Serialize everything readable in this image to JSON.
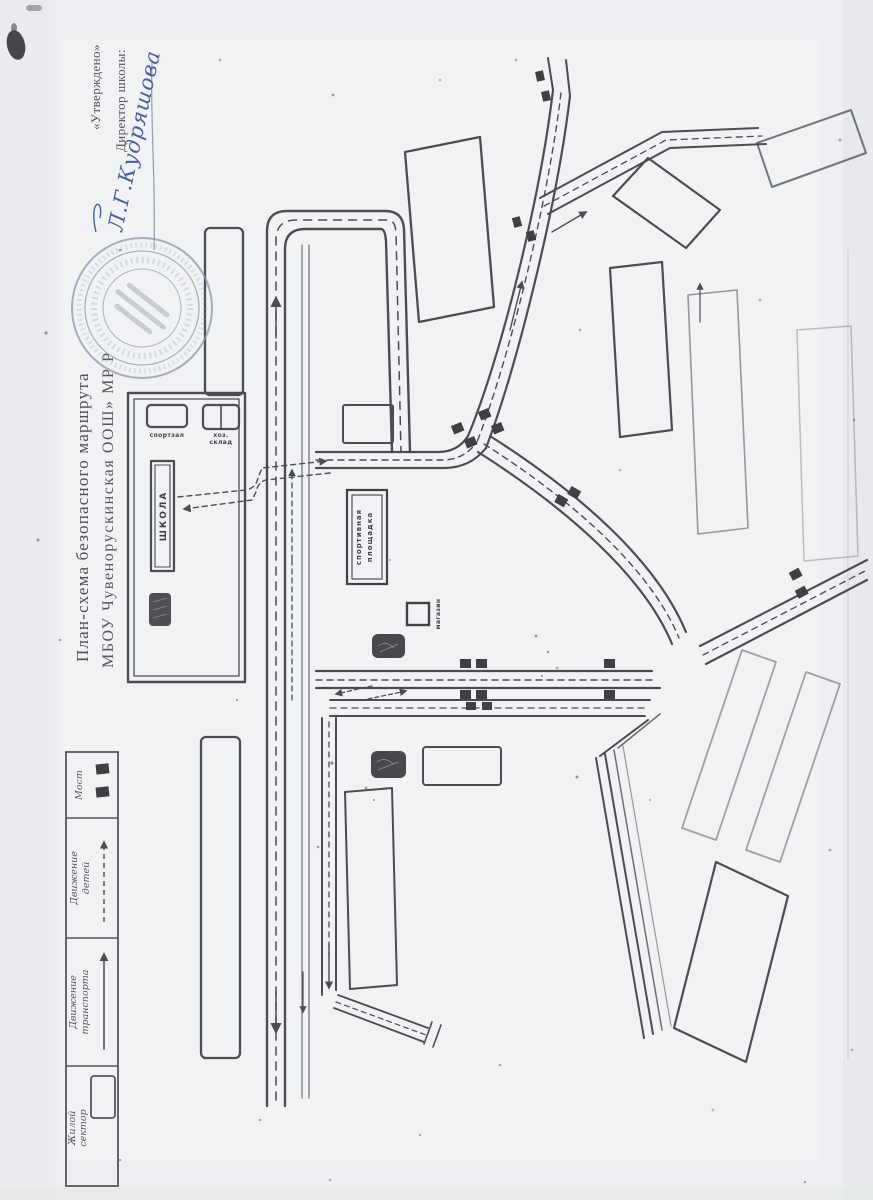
{
  "document": {
    "approval_quote": "«Утверждено»",
    "approval_role": "Директор школы:",
    "approval_signature": "Л.Г.Кудряшова",
    "title_line1": "План-схема безопасного маршрута",
    "title_line2": "МБОУ Чувенорускинская ООШ» МР Р"
  },
  "map": {
    "school_label": "ШКОЛА",
    "sport_hall_label": "спортзал",
    "storage_label_line1": "хоз.",
    "storage_label_line2": "склад",
    "sports_ground_line1": "спортивная",
    "sports_ground_line2": "площадка",
    "shop_label": "магазин"
  },
  "legend": {
    "items": [
      {
        "name": "residential-area",
        "line1": "Жилой",
        "line2": "сектор",
        "symbol": "rectangle-outline"
      },
      {
        "name": "traffic-movement",
        "line1": "Движение",
        "line2": "транспорта",
        "symbol": "solid-arrow"
      },
      {
        "name": "children-movement",
        "line1": "Движение",
        "line2": "детей",
        "symbol": "dashed-arrow"
      },
      {
        "name": "bridge",
        "line1": "Мост",
        "line2": "",
        "symbol": "two-filled-squares"
      }
    ]
  },
  "colors": {
    "paper": "#edeff2",
    "ink": "#4b4d51",
    "stamp": "#8e94a8",
    "signature": "#4a5f9f"
  }
}
